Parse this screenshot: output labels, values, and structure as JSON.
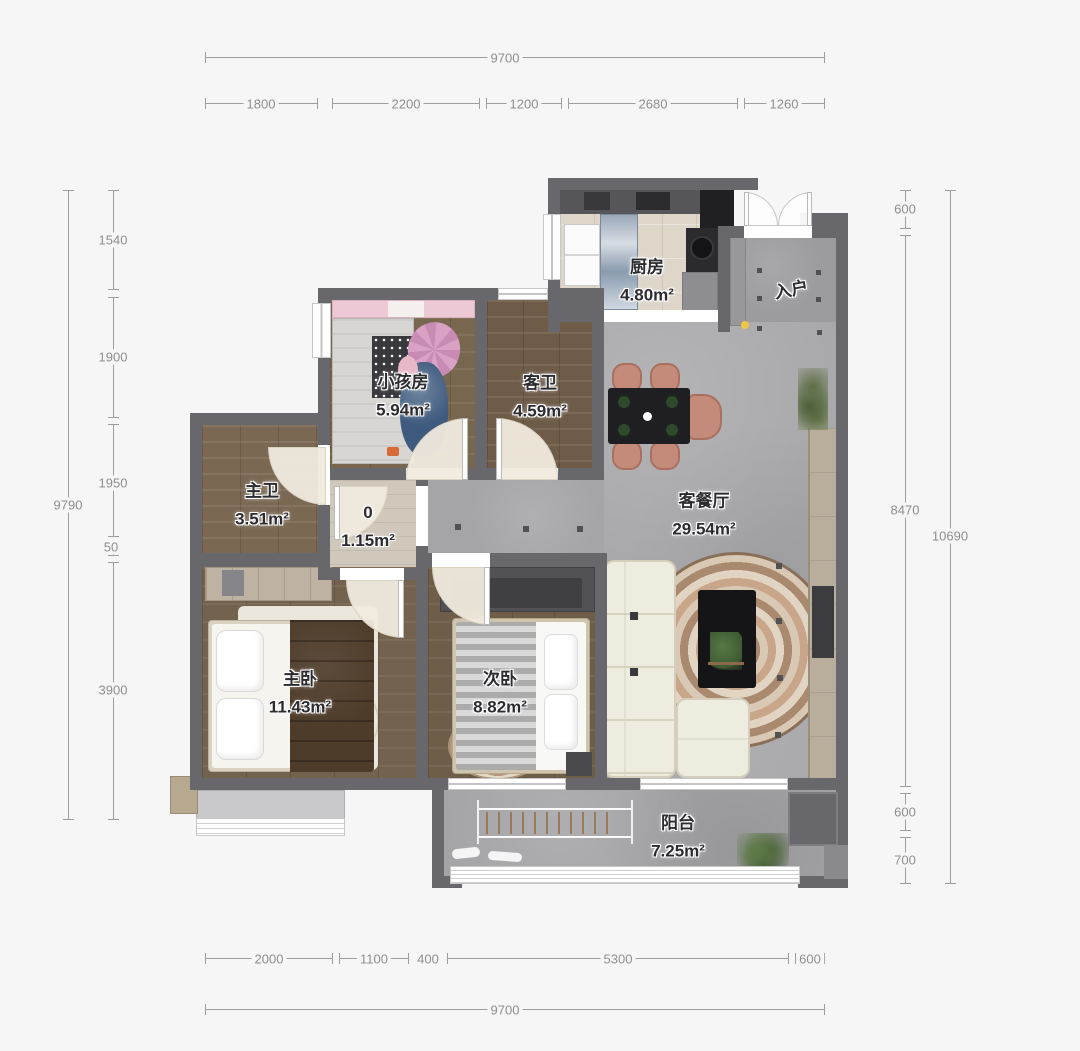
{
  "dimensions": {
    "top": {
      "total": "9700",
      "segments": [
        "1800",
        "2200",
        "1200",
        "2680",
        "1260"
      ]
    },
    "left": {
      "total": "9790",
      "segments": [
        "1540",
        "1900",
        "1950",
        "50",
        "3900"
      ]
    },
    "right": {
      "total": "10690",
      "segments": [
        "600",
        "8470",
        "600",
        "700"
      ]
    },
    "bottom": {
      "total": "9700",
      "segments": [
        "2000",
        "1100",
        "400",
        "5300",
        "600"
      ]
    }
  },
  "rooms": {
    "kitchen": {
      "name": "厨房",
      "area": "4.80m²"
    },
    "entry": {
      "name": "入户"
    },
    "kids_room": {
      "name": "小孩房",
      "area": "5.94m²"
    },
    "guest_bath": {
      "name": "客卫",
      "area": "4.59m²"
    },
    "master_bath": {
      "name": "主卫",
      "area": "3.51m²"
    },
    "hallway": {
      "name": "0",
      "area": "1.15m²"
    },
    "living_dining": {
      "name": "客餐厅",
      "area": "29.54m²"
    },
    "master_bedroom": {
      "name": "主卧",
      "area": "11.43m²"
    },
    "second_bedroom": {
      "name": "次卧",
      "area": "8.82m²"
    },
    "balcony": {
      "name": "阳台",
      "area": "7.25m²"
    }
  },
  "colors": {
    "wall": "#68686c",
    "concrete_floor": "#a8a7a9",
    "wood_floor_dark": "#6e5d49",
    "wood_floor_mid": "#77674f",
    "kitchen_floor": "#ddd6c9",
    "sofa": "#eeecdf",
    "dining_chair": "#c48a7a",
    "rug_swirl": "#c9a58a",
    "door_arc_fill": "#f0e9db",
    "dimension_text": "#8e8e8e",
    "label_text": "#2c2c30",
    "door_handle_dot": "#f0c64a",
    "plant": "#4a6338"
  }
}
